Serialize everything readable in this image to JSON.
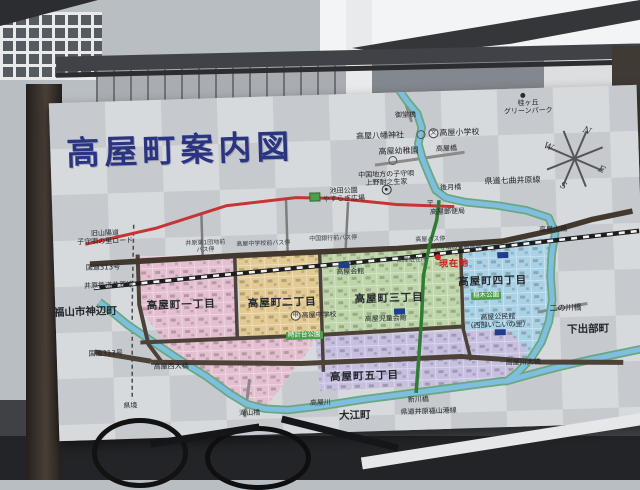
{
  "sign": {
    "title": "高屋町案内図",
    "compass": {
      "n": "N",
      "e": "E",
      "s": "S",
      "w": "W"
    },
    "accent_colors": {
      "title_navy": "#2b3480",
      "current_location_red": "#cc1f1f",
      "old_road_red": "#c63434",
      "pref_road_green": "#2e7d32",
      "river_blue": "#7fbede"
    },
    "districts": [
      {
        "name": "高屋町一丁目",
        "color": "#e4bfd2",
        "points": "84,156 182,156 182,240 256,240 256,250 208,310 190,306 120,258 84,208"
      },
      {
        "name": "高屋町二丁目",
        "color": "#e2ca92",
        "points": "184,156 264,156 264,240 184,240"
      },
      {
        "name": "高屋町三丁目",
        "color": "#bdd5a9",
        "points": "268,156 406,156 406,238 268,238"
      },
      {
        "name": "高屋町四丁目",
        "color": "#aad2e6",
        "points": "409,154 497,150 500,170 498,212 488,248 470,274 440,274 409,240"
      },
      {
        "name": "高屋町五丁目",
        "color": "#c6bfdf",
        "points": "259,242 452,240 470,262 449,290 420,293 262,296"
      }
    ],
    "paths": [
      {
        "n": "pref-border-line",
        "d": "M81,124 L77,204 74,299",
        "s": "#4a4a4a",
        "w": 1.5,
        "dash": "4 3"
      },
      {
        "n": "road-takayabashi",
        "d": "M324,72 L414,62",
        "s": "#8a8a8a",
        "w": 3
      },
      {
        "n": "road-midobashi",
        "d": "M354,2 L362,30",
        "s": "#8a8a8a",
        "w": 3
      },
      {
        "n": "road-ninokawa",
        "d": "M482,224 L532,217",
        "s": "#8a8a8a",
        "w": 3
      },
      {
        "n": "road-takiyama",
        "d": "M192,282 L186,320",
        "s": "#8a8a8a",
        "w": 3
      },
      {
        "n": "road-branch-1",
        "d": "M149,114 L149,158",
        "s": "#7d7d7d",
        "w": 2.5
      },
      {
        "n": "road-branch-2",
        "d": "M234,104 L234,158",
        "s": "#7d7d7d",
        "w": 2.5
      },
      {
        "n": "road-branch-3",
        "d": "M296,108 L292,156",
        "s": "#7d7d7d",
        "w": 2.5
      },
      {
        "n": "river-main-bank",
        "d": "M44,200 L56,210 72,224 94,240 122,260 149,278 172,296 189,307 206,312 229,314 264,311 304,306 344,302 384,298 414,295 444,292 449,292 469,287 499,280 534,273 569,267 586,264",
        "s": "#69a87e",
        "w": 8.5
      },
      {
        "n": "river-north-bank",
        "d": "M350,-3 L358,9 368,22 372,36 368,52 372,68 378,84 384,99 394,107 414,112 444,116 474,122 496,130 502,146 498,166 496,189 497,212 493,234 485,254 474,270 460,284 449,292",
        "s": "#69a87e",
        "w": 8.5
      },
      {
        "n": "river-takayagawa",
        "d": "M44,200 L56,210 72,224 94,240 122,260 149,278 172,296 189,307 206,312 229,314 264,311 304,306 344,302 384,298 414,295 444,292 449,292 469,287 499,280 534,273 569,267 586,264",
        "s": "#7fbede",
        "w": 5
      },
      {
        "n": "river-north",
        "d": "M350,-3 L358,9 368,22 372,36 368,52 372,68 378,84 384,99 394,107 414,112 444,116 474,122 496,130 502,146 498,166 496,189 497,212 493,234 485,254 474,270 460,284 449,292",
        "s": "#7fbede",
        "w": 5
      },
      {
        "n": "road-west",
        "d": "M84,154 L84,204 92,244 104,261",
        "s": "#4c4238",
        "w": 4
      },
      {
        "n": "road-mid",
        "d": "M84,242 L264,240 409,236",
        "s": "#4c4238",
        "w": 4
      },
      {
        "n": "road-bottom",
        "d": "M94,262 L244,268 404,266 484,274 566,277",
        "s": "#4c4238",
        "w": 5
      },
      {
        "n": "road-313-southwest",
        "d": "M38,250 L94,261",
        "s": "#4c4238",
        "w": 5
      },
      {
        "n": "road-v1",
        "d": "M181,156 L181,241",
        "s": "#4c4238",
        "w": 3.5
      },
      {
        "n": "road-v2",
        "d": "M266,156 L266,277",
        "s": "#4c4238",
        "w": 3.5
      },
      {
        "n": "road-v3",
        "d": "M407,156 L407,238 414,270",
        "s": "#4c4238",
        "w": 3.5
      },
      {
        "n": "route-313",
        "d": "M36,162 L184,158 344,156 449,152 504,142 540,133 580,126",
        "s": "#42382e",
        "w": 5.5
      },
      {
        "n": "railway-ibara-base",
        "d": "M39,186 L184,176 344,166 464,156 586,146",
        "s": "#1d1d1d",
        "w": 4.5
      },
      {
        "n": "railway-ibara-ties",
        "d": "M39,186 L184,176 344,166 464,156 586,146",
        "s": "#f2f2f2",
        "w": 2.6,
        "dash": "6 6"
      },
      {
        "n": "road-old-sanyodo",
        "d": "M32,142 L104,128 174,108 244,102 284,104 344,112 402,116",
        "s": "#c63434",
        "w": 3
      },
      {
        "n": "road-pref-nanamagari",
        "d": "M387,109 L384,129 376,154 369,184 366,224 362,264 358,301",
        "s": "#2e7d32",
        "w": 3.5
      }
    ],
    "labels": [
      {
        "t": "御堂橋",
        "x": 356,
        "y": 23,
        "c": "tiny"
      },
      {
        "t": "桂ヶ丘\nグリーンパーク",
        "x": 479,
        "y": 19,
        "c": "tiny"
      },
      {
        "t": "高屋八幡神社",
        "x": 330,
        "y": 43,
        "c": "plain"
      },
      {
        "t": "高屋小学校",
        "x": 404,
        "y": 42,
        "c": "plain",
        "sym": "文"
      },
      {
        "t": "高屋幼稚園",
        "x": 348,
        "y": 59,
        "c": "plain"
      },
      {
        "t": "高屋橋",
        "x": 396,
        "y": 58,
        "c": "tiny"
      },
      {
        "t": "中国地方の子守唄\n上野耐之生家",
        "x": 335,
        "y": 86,
        "c": "tiny"
      },
      {
        "t": "後月橋",
        "x": 399,
        "y": 97,
        "c": "tiny"
      },
      {
        "t": "県道七曲井原線",
        "x": 461,
        "y": 92,
        "c": "plain"
      },
      {
        "t": "高屋郵便局",
        "x": 395,
        "y": 121,
        "c": "tiny"
      },
      {
        "t": "高屋大橋",
        "x": 500,
        "y": 142,
        "c": "tiny"
      },
      {
        "t": "池田公園\nやすらぎ広場",
        "x": 292,
        "y": 101,
        "c": "tiny"
      },
      {
        "t": "旧山陽道\n子守唄の里ロード",
        "x": 52,
        "y": 136,
        "c": "tiny"
      },
      {
        "t": "国道313号",
        "x": 49,
        "y": 166,
        "c": "tiny"
      },
      {
        "t": "井原鉄道井原線",
        "x": 54,
        "y": 184,
        "c": "tiny"
      },
      {
        "t": "福山市神辺町",
        "x": 30,
        "y": 210,
        "c": "area"
      },
      {
        "t": "国道313号",
        "x": 49,
        "y": 252,
        "c": "tiny"
      },
      {
        "t": "県境",
        "x": 72,
        "y": 305,
        "c": "tiny"
      },
      {
        "t": "高屋西大橋",
        "x": 114,
        "y": 267,
        "c": "tiny"
      },
      {
        "t": "滝山橋",
        "x": 191,
        "y": 316,
        "c": "tiny"
      },
      {
        "t": "高屋川",
        "x": 262,
        "y": 308,
        "c": "tiny"
      },
      {
        "t": "大江町",
        "x": 296,
        "y": 322,
        "c": "area"
      },
      {
        "t": "新川橋",
        "x": 360,
        "y": 308,
        "c": "tiny"
      },
      {
        "t": "県道井原福山港線",
        "x": 370,
        "y": 320,
        "c": "tiny"
      },
      {
        "t": "高屋川大橋",
        "x": 466,
        "y": 274,
        "c": "tiny"
      },
      {
        "t": "二の川橋",
        "x": 510,
        "y": 221,
        "c": "plain"
      },
      {
        "t": "下出部町",
        "x": 532,
        "y": 243,
        "c": "area"
      },
      {
        "t": "高屋町一丁目",
        "x": 126,
        "y": 206,
        "c": "district"
      },
      {
        "t": "高屋町二丁目",
        "x": 227,
        "y": 207,
        "c": "district"
      },
      {
        "t": "高屋町三丁目",
        "x": 334,
        "y": 206,
        "c": "district"
      },
      {
        "t": "高屋町四丁目",
        "x": 438,
        "y": 192,
        "c": "district"
      },
      {
        "t": "高屋町五丁目",
        "x": 307,
        "y": 283,
        "c": "district"
      },
      {
        "t": "高屋中学校",
        "x": 258,
        "y": 220,
        "c": "tiny",
        "sym": "中"
      },
      {
        "t": "高屋会館",
        "x": 296,
        "y": 178,
        "c": "tiny"
      },
      {
        "t": "高屋児童会館",
        "x": 330,
        "y": 226,
        "c": "tiny"
      },
      {
        "t": "高屋公民館\n（西部いこいの里）",
        "x": 442,
        "y": 232,
        "c": "tiny"
      },
      {
        "t": "時計台公園",
        "x": 248,
        "y": 240,
        "c": "park"
      },
      {
        "t": "稲木公園",
        "x": 431,
        "y": 206,
        "c": "park"
      },
      {
        "t": "子守唄の里高屋駅",
        "x": 404,
        "y": 157,
        "c": "micro"
      },
      {
        "t": "高屋駐在所",
        "x": 358,
        "y": 168,
        "c": "micro"
      },
      {
        "t": "現在地",
        "x": 400,
        "y": 174,
        "c": "here"
      },
      {
        "t": "高屋バス停",
        "x": 377,
        "y": 148,
        "c": "micro"
      },
      {
        "t": "井原第1団地前\nバス停",
        "x": 152,
        "y": 148,
        "c": "micro"
      },
      {
        "t": "高屋中学校前バス停",
        "x": 210,
        "y": 147,
        "c": "micro"
      },
      {
        "t": "中国銀行前バス停",
        "x": 280,
        "y": 144,
        "c": "micro"
      }
    ],
    "markers": [
      {
        "type": "dot",
        "x": 474,
        "y": 7,
        "name": "greenpark-dot"
      },
      {
        "type": "square",
        "x": 263,
        "y": 102,
        "name": "ikeda-park-symbol"
      },
      {
        "type": "dcircle",
        "x": 335,
        "y": 97,
        "name": "birthplace-symbol"
      },
      {
        "type": "postal",
        "x": 378,
        "y": 112,
        "t": "〒",
        "name": "post-office-symbol"
      },
      {
        "type": "navy",
        "x": 290,
        "y": 171,
        "name": "takaya-hall-building"
      },
      {
        "type": "navy",
        "x": 449,
        "y": 166,
        "name": "takaya-station-building"
      },
      {
        "type": "navy",
        "x": 344,
        "y": 219,
        "name": "childrens-hall-building"
      },
      {
        "type": "navy",
        "x": 444,
        "y": 243,
        "name": "community-center-building"
      },
      {
        "type": "reddot",
        "x": 384,
        "y": 166,
        "name": "current-location-dot"
      },
      {
        "type": "circle",
        "x": 371,
        "y": 43,
        "name": "shrine-symbol"
      },
      {
        "type": "circle",
        "x": 342,
        "y": 68,
        "name": "kindergarten-symbol"
      }
    ]
  }
}
